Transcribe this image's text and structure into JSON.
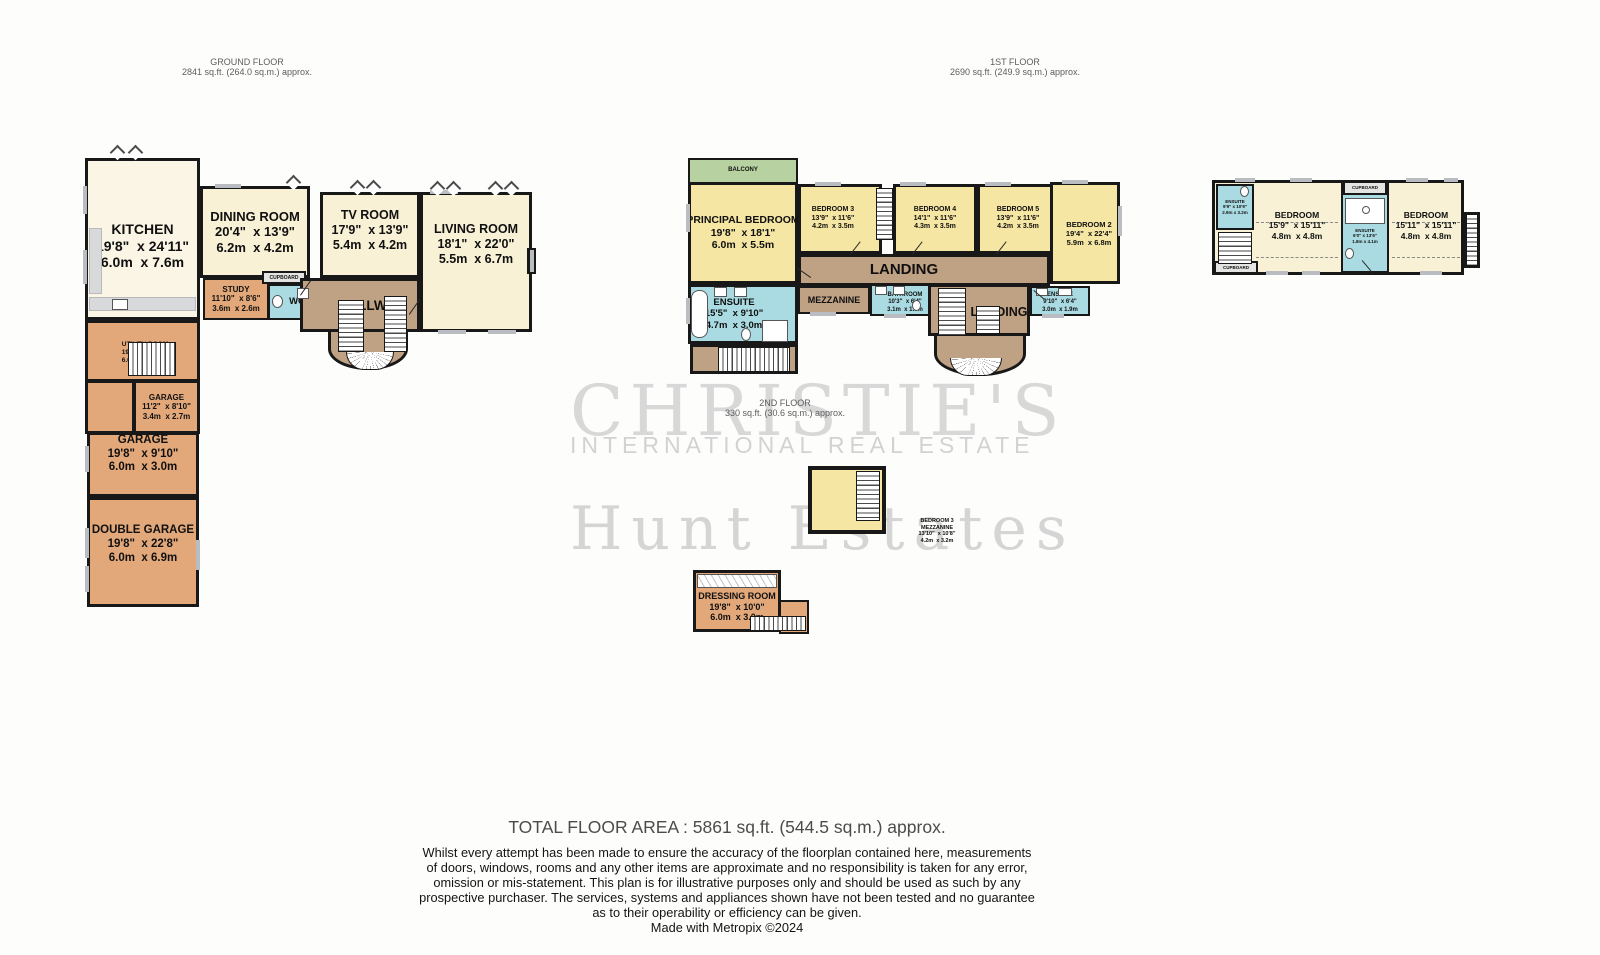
{
  "floors": {
    "ground": {
      "title": "GROUND FLOOR",
      "area": "2841 sq.ft. (264.0 sq.m.) approx."
    },
    "first": {
      "title": "1ST FLOOR",
      "area": "2690 sq.ft. (249.9 sq.m.) approx."
    },
    "second": {
      "title": "2ND FLOOR",
      "area": "330 sq.ft. (30.6 sq.m.) approx."
    }
  },
  "watermark": {
    "brand": "CHRISTIE'S",
    "brand_sub": "INTERNATIONAL REAL ESTATE",
    "agency": "Hunt Estates"
  },
  "ground_floor": {
    "kitchen": {
      "name": "KITCHEN",
      "imperial": "19'8\"  x 24'11\"",
      "metric": "6.0m  x 7.6m"
    },
    "dining_room": {
      "name": "DINING ROOM",
      "imperial": "20'4\"  x 13'9\"",
      "metric": "6.2m  x 4.2m"
    },
    "tv_room": {
      "name": "TV ROOM",
      "imperial": "17'9\"  x 13'9\"",
      "metric": "5.4m  x 4.2m"
    },
    "living_room": {
      "name": "LIVING ROOM",
      "imperial": "18'1\"  x 22'0\"",
      "metric": "5.5m  x 6.7m"
    },
    "study": {
      "name": "STUDY",
      "imperial": "11'10\"  x 8'6\"",
      "metric": "3.6m  x 2.6m"
    },
    "wc": {
      "name": "WC"
    },
    "cupboard": {
      "name": "CUPBOARD"
    },
    "hallway": {
      "name": "HALLWAY"
    },
    "utility_room": {
      "name": "UTILITY ROOM",
      "imperial": "19'8\"  x 17'11\"",
      "metric": "6.0m  x 5.5m"
    },
    "garage_small": {
      "name": "GARAGE",
      "imperial": "11'2\"  x 8'10\"",
      "metric": "3.4m  x 2.7m"
    },
    "garage": {
      "name": "GARAGE",
      "imperial": "19'8\"  x 9'10\"",
      "metric": "6.0m  x 3.0m"
    },
    "double_garage": {
      "name": "DOUBLE GARAGE",
      "imperial": "19'8\"  x 22'8\"",
      "metric": "6.0m  x 6.9m"
    }
  },
  "first_floor": {
    "balcony": {
      "name": "BALCONY"
    },
    "principal_bedroom": {
      "name": "PRINCIPAL BEDROOM",
      "imperial": "19'8\"  x 18'1\"",
      "metric": "6.0m  x 5.5m"
    },
    "bedroom3": {
      "name": "BEDROOM 3",
      "imperial": "13'9\"  x 11'6\"",
      "metric": "4.2m  x 3.5m"
    },
    "bedroom4": {
      "name": "BEDROOM 4",
      "imperial": "14'1\"  x 11'6\"",
      "metric": "4.3m  x 3.5m"
    },
    "bedroom5": {
      "name": "BEDROOM 5",
      "imperial": "13'9\"  x 11'6\"",
      "metric": "4.2m  x 3.5m"
    },
    "bedroom2": {
      "name": "BEDROOM 2",
      "imperial": "19'4\"  x 22'4\"",
      "metric": "5.9m  x 6.8m"
    },
    "landing_main": {
      "name": "LANDING"
    },
    "landing_second": {
      "name": "LANDING"
    },
    "mezzanine": {
      "name": "MEZZANINE"
    },
    "bathroom": {
      "name": "BATHROOM",
      "imperial": "10'3\"  x 6'4\"",
      "metric": "3.1m  x 1.9m"
    },
    "principal_ensuite": {
      "name": "ENSUITE",
      "imperial": "15'5\"  x 9'10\"",
      "metric": "4.7m  x 3.0m"
    },
    "landing_ensuite": {
      "name": "ENSUITE",
      "imperial": "9'10\"  x 6'4\"",
      "metric": "3.0m  x 1.9m"
    },
    "annex": {
      "bedroom_left": {
        "name": "BEDROOM",
        "imperial": "15'9\"  x 15'11\"",
        "metric": "4.8m  x 4.8m"
      },
      "bedroom_right": {
        "name": "BEDROOM",
        "imperial": "15'11\"  x 15'11\"",
        "metric": "4.8m  x 4.8m"
      },
      "ensuite_left": {
        "name": "ENSUITE",
        "imperial": "9'9\" x 10'9\"",
        "metric": "2.9m x 3.2m"
      },
      "ensuite_mid": {
        "name": "ENSUITE",
        "imperial": "6'0\" x 13'6\"",
        "metric": "1.8m x 4.1m"
      },
      "cupboard_top": {
        "name": "CUPBOARD"
      },
      "cupboard_bottom": {
        "name": "CUPBOARD"
      }
    }
  },
  "second_floor": {
    "bedroom3_mezzanine": {
      "name": "BEDROOM 3",
      "name2": "MEZZANINE",
      "imperial": "13'10\"  x 10'8\"",
      "metric": "4.2m  x 3.2m"
    },
    "dressing_room": {
      "name": "DRESSING ROOM",
      "imperial": "19'8\"  x 10'0\"",
      "metric": "6.0m  x 3.0m"
    }
  },
  "footer": {
    "total": "TOTAL FLOOR AREA : 5861 sq.ft. (544.5 sq.m.) approx.",
    "disclaimer_lines": [
      "Whilst every attempt has been made to ensure the accuracy of the floorplan contained here, measurements",
      "of doors, windows, rooms and any other items are approximate and no responsibility is taken for any error,",
      "omission or mis-statement. This plan is for illustrative purposes only and should be used as such by any",
      "prospective purchaser. The services, systems and appliances shown have not been tested and no guarantee",
      "as to their operability or efficiency can be given."
    ],
    "credit": "Made with Metropix ©2024"
  },
  "colors": {
    "room_cream": "#f8f1d6",
    "room_pale": "#faf5e4",
    "room_yellow": "#f5e6a3",
    "room_orange": "#e2a87a",
    "hall_tan": "#bfa183",
    "wet_blue": "#aadbe3",
    "balcony_green": "#b7d1a0",
    "wall": "#181818",
    "window_marker": "#b9bdc2",
    "watermark": "#d6d6d6"
  }
}
